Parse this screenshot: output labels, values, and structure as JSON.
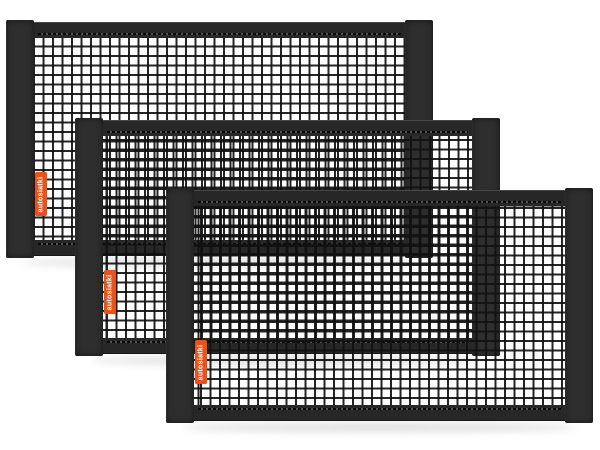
{
  "scene": {
    "description": "Product photo: set of three black elastic car cargo nets with dark fabric frames, stacked overlapping diagonally on a white background",
    "background_color": "#ffffff"
  },
  "colors": {
    "fabric_strap": "#2e2e2f",
    "fabric_bar": "#272728",
    "mesh_line": "#111111",
    "label_orange": "#e4551c",
    "label_text": "#ffffff",
    "shadow": "#bfbfbf"
  },
  "nets": [
    {
      "id": "back",
      "label": "autosiatki"
    },
    {
      "id": "middle",
      "label": "autosiatki"
    },
    {
      "id": "front",
      "label": "autosiatki"
    }
  ]
}
